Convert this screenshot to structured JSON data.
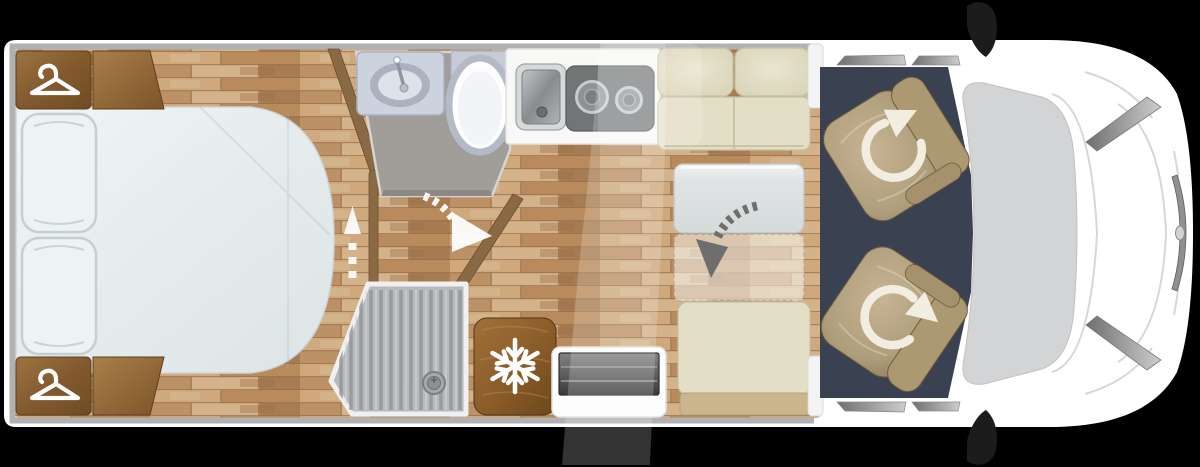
{
  "scene": {
    "name": "motorhome-floor-plan",
    "view": "top-down",
    "vehicle_orientation": "front-right"
  },
  "colors": {
    "background": "#000000",
    "body": "#ffffff",
    "wall": "#b1b1b1",
    "floor_base": "#c2946a",
    "mattress": "#e9eff1",
    "pillow": "#edf3f4",
    "wardrobe_wood": "#8a6238",
    "partition_wood": "#8a6a45",
    "bathroom_floor": "#a19e99",
    "fixture_gray": "#ccd2de",
    "toilet_white": "#fdfdfe",
    "counter": "#f8f8f7",
    "sink_steel": "#9da0a3",
    "hob": "#727476",
    "shower_tray": "#b7babc",
    "fridge_wood": "#8e6029",
    "cushion": "#e3dfc6",
    "cushion_base": "#c9b68c",
    "table": "#e4e7e7",
    "step_dark": "#4a4a4a",
    "cab_floor": "#3a4252",
    "seat_tan": "#b7a480",
    "windshield": "#d2d4d5",
    "trim_gray": "#9a9a9a",
    "mirror_black": "#1c1c1c",
    "white_icon": "#ffffff",
    "gray_arrow": "#6e6e6e"
  },
  "features": {
    "bedroom": {
      "bed": 1,
      "pillows": 2,
      "wardrobes_with_hanger": 2,
      "wood_panels": 2
    },
    "bathroom": {
      "washbasin": 1,
      "toilet": 1,
      "door_swing_arrow": 1
    },
    "shower": {
      "tray": 1,
      "drain": 1
    },
    "kitchen": {
      "steel_sink": 1,
      "hob_burners": 2,
      "fridge_freezer": 1
    },
    "dinette": {
      "bench_seats": 2,
      "table": 1,
      "table_fold_arrow": 1,
      "entry_step": 1
    },
    "cab": {
      "swivel_seats": 2,
      "swivel_arrows": 2,
      "mirrors": 2,
      "headlights": 2
    },
    "arrows": {
      "bed_slide_arrow": 1,
      "door_swing_arrow": 1,
      "table_fold_arrow": 1,
      "seat_swivel_arrows": 2
    }
  },
  "icons": [
    {
      "name": "hanger-icon",
      "meaning": "wardrobe",
      "count": 2
    },
    {
      "name": "snowflake-icon",
      "meaning": "fridge-freezer",
      "count": 1
    },
    {
      "name": "rotate-arrow-icon",
      "meaning": "swivel cab seat",
      "count": 2
    },
    {
      "name": "door-swing-arrow-icon",
      "meaning": "bathroom door swing",
      "count": 1
    },
    {
      "name": "fold-arrow-icon",
      "meaning": "table folds down",
      "count": 1
    },
    {
      "name": "slide-arrow-icon",
      "meaning": "bed extends",
      "count": 1
    }
  ]
}
